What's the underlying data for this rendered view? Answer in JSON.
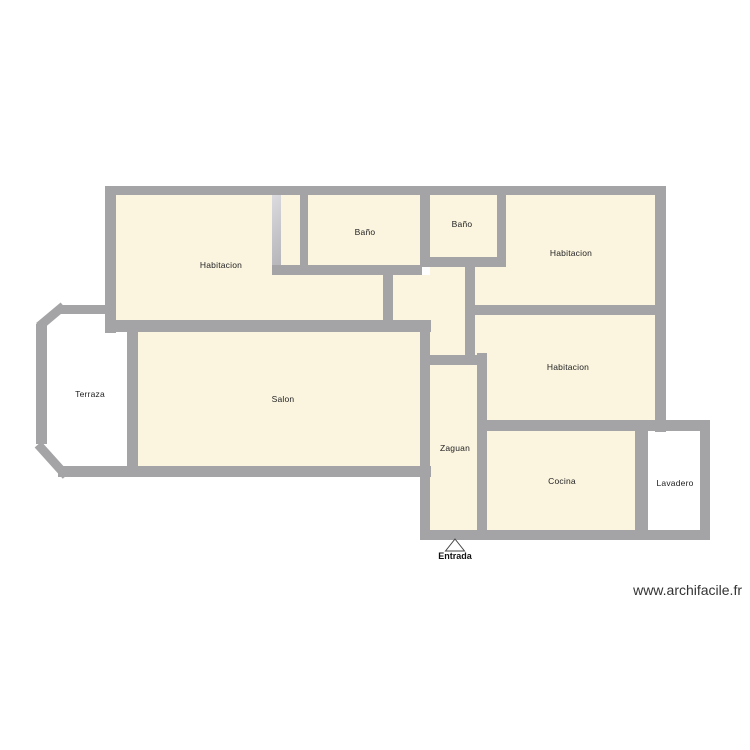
{
  "palette": {
    "room_fill": "#fbf5e0",
    "wall": "#a4a4a7",
    "wall_light": "#c7c7cc",
    "label_color": "#222222",
    "background": "#ffffff"
  },
  "floor_plan": {
    "rooms": [
      {
        "id": "habitacion-left",
        "label": "Habitacion"
      },
      {
        "id": "bano-1",
        "label": "Baño"
      },
      {
        "id": "bano-2",
        "label": "Baño"
      },
      {
        "id": "habitacion-right-top",
        "label": "Habitacion"
      },
      {
        "id": "habitacion-right-middle",
        "label": "Habitacion"
      },
      {
        "id": "salon",
        "label": "Salon"
      },
      {
        "id": "terraza",
        "label": "Terraza"
      },
      {
        "id": "zaguan",
        "label": "Zaguan"
      },
      {
        "id": "cocina",
        "label": "Cocina"
      },
      {
        "id": "lavadero",
        "label": "Lavadero"
      }
    ],
    "entrance_label": "Entrada"
  },
  "watermark": "www.archifacile.fr"
}
